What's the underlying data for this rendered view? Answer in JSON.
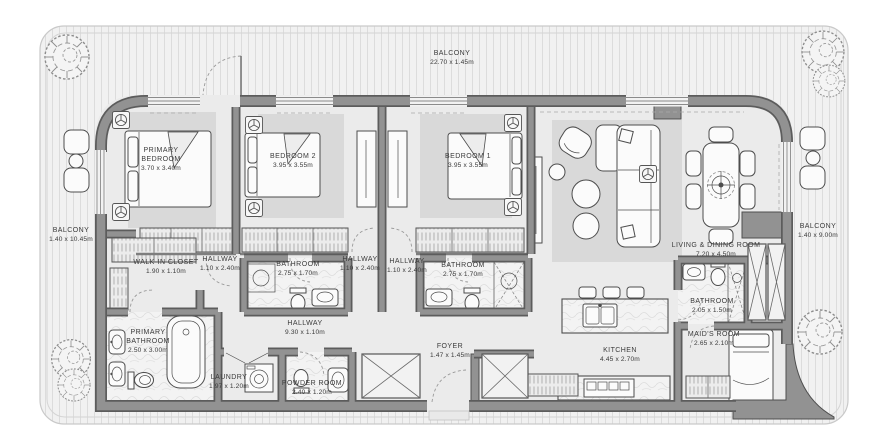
{
  "rooms": {
    "balcony_top": {
      "name": "BALCONY",
      "dims": "22.70 x 1.45m"
    },
    "balcony_left": {
      "name": "BALCONY",
      "dims": "1.40 x 10.45m"
    },
    "balcony_right": {
      "name": "BALCONY",
      "dims": "1.40 x 9.00m"
    },
    "primary_bedroom": {
      "name1": "PRIMARY",
      "name2": "BEDROOM",
      "dims": "3.70 x 3.40m"
    },
    "bedroom_2": {
      "name": "BEDROOM 2",
      "dims": "3.95 x 3.55m"
    },
    "bedroom_1": {
      "name": "BEDROOM 1",
      "dims": "3.95 x 3.55m"
    },
    "living_dining": {
      "name": "LIVING & DINING ROOM",
      "dims": "7.20 x 4.50m"
    },
    "walk_in_closet": {
      "name": "WALK-IN CLOSET",
      "dims": "1.90 x 1.10m"
    },
    "hallway_left": {
      "name": "HALLWAY",
      "dims": "1.10 x 2.40m"
    },
    "bathroom_2": {
      "name": "BATHROOM",
      "dims": "2.75 x 1.70m"
    },
    "hallway_mid": {
      "name": "HALLWAY",
      "dims": "1.10 x 2.40m"
    },
    "hallway_right": {
      "name": "HALLWAY",
      "dims": "1.10 x 2.40m"
    },
    "bathroom_1": {
      "name": "BATHROOM",
      "dims": "2.75 x 1.70m"
    },
    "primary_bathroom": {
      "name1": "PRIMARY",
      "name2": "BATHROOM",
      "dims": "2.50 x 3.00m"
    },
    "hallway_main": {
      "name": "HALLWAY",
      "dims": "9.30 x 1.10m"
    },
    "laundry": {
      "name": "LAUNDRY",
      "dims": "1.97 x 1.20m"
    },
    "powder_room": {
      "name": "POWDER ROOM",
      "dims": "2.40 x 1.20m"
    },
    "foyer": {
      "name": "FOYER",
      "dims": "1.47 x 1.45m"
    },
    "kitchen": {
      "name": "KITCHEN",
      "dims": "4.45 x 2.70m"
    },
    "bathroom_maid": {
      "name": "BATHROOM",
      "dims": "2.05 x 1.50m"
    },
    "maids_room": {
      "name": "MAID'S ROOM",
      "dims": "2.65 x 2.10m"
    }
  },
  "colors": {
    "wall": "#929292",
    "wall_dark": "#5c5c5c",
    "floor": "#ebebeb",
    "carpet": "#d9d9d9",
    "balcony_floor": "#f1f1f1",
    "balcony_stripe": "#dcdcdc",
    "label_text": "#3b3b3b"
  }
}
